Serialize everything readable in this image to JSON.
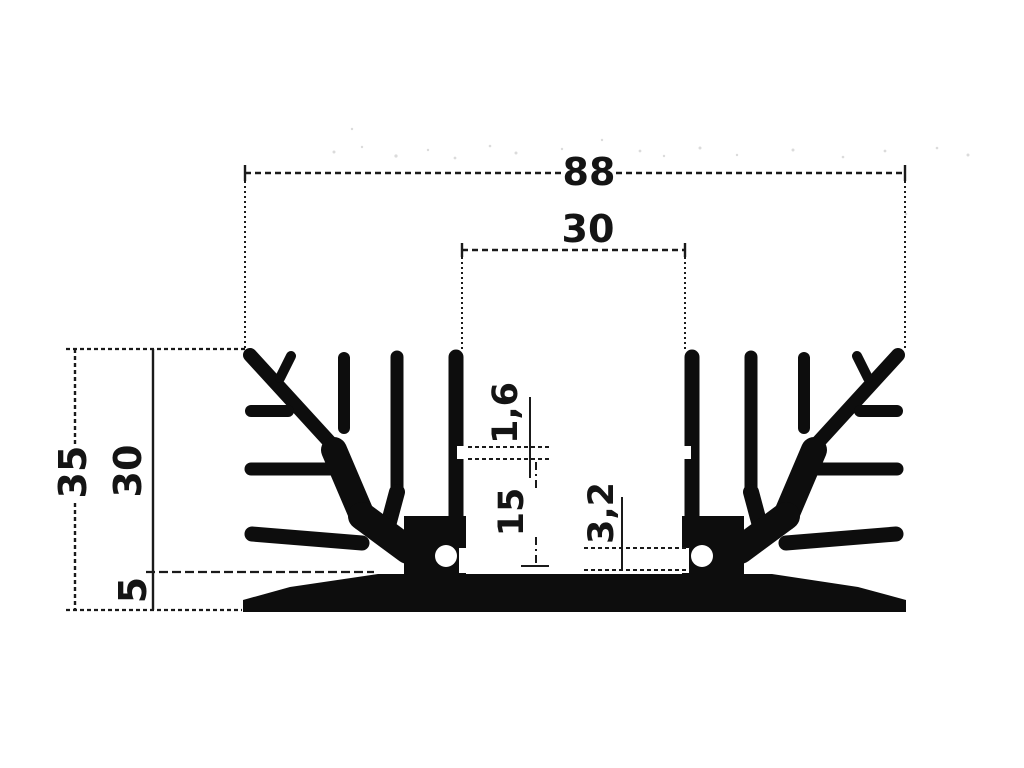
{
  "drawing": {
    "type": "technical-drawing",
    "subject": "Heatsink extrusion profile cross-section with dimensions",
    "paper_color": "#ffffff",
    "ink_color": "#141414",
    "labels": {
      "overall_width": "88",
      "center_gap": "30",
      "overall_height": "35",
      "fin_height": "30",
      "base_thickness": "5",
      "post_notch": "1,6",
      "cavity_depth": "15",
      "slot_height": "3,2"
    }
  }
}
